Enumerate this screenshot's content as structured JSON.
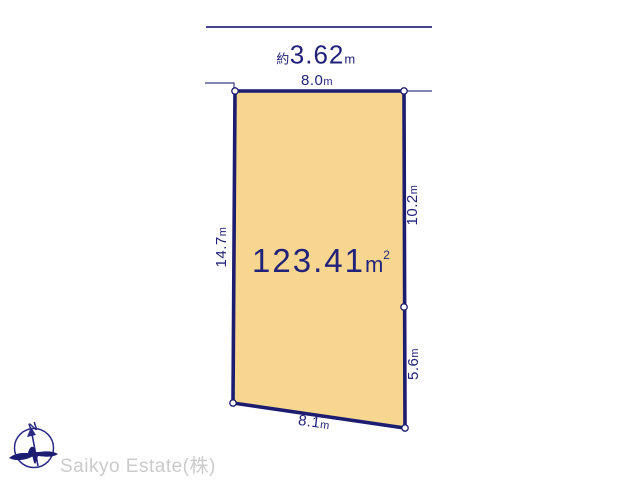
{
  "colors": {
    "navy": "#22227b",
    "plot_border": "#1c1c70",
    "plot_fill": "#f7d78f",
    "company_gray": "#cbcbcb"
  },
  "labels": {
    "road_dim": {
      "prefix": "約",
      "value": "3.62",
      "unit": "m"
    },
    "top_edge": {
      "value": "8.0",
      "unit": "m"
    },
    "left_edge": {
      "value": "14.7",
      "unit": "m"
    },
    "right_upper_edge": {
      "value": "10.2",
      "unit": "m"
    },
    "right_lower_edge": {
      "value": "5.6",
      "unit": "m"
    },
    "bottom_edge": {
      "value": "8.1",
      "unit": "m"
    },
    "area": {
      "value": "123.41",
      "unit": "m",
      "superscript": "2"
    }
  },
  "compass": {
    "label": "N"
  },
  "footer": {
    "company": "Saikyo Estate(株)"
  }
}
